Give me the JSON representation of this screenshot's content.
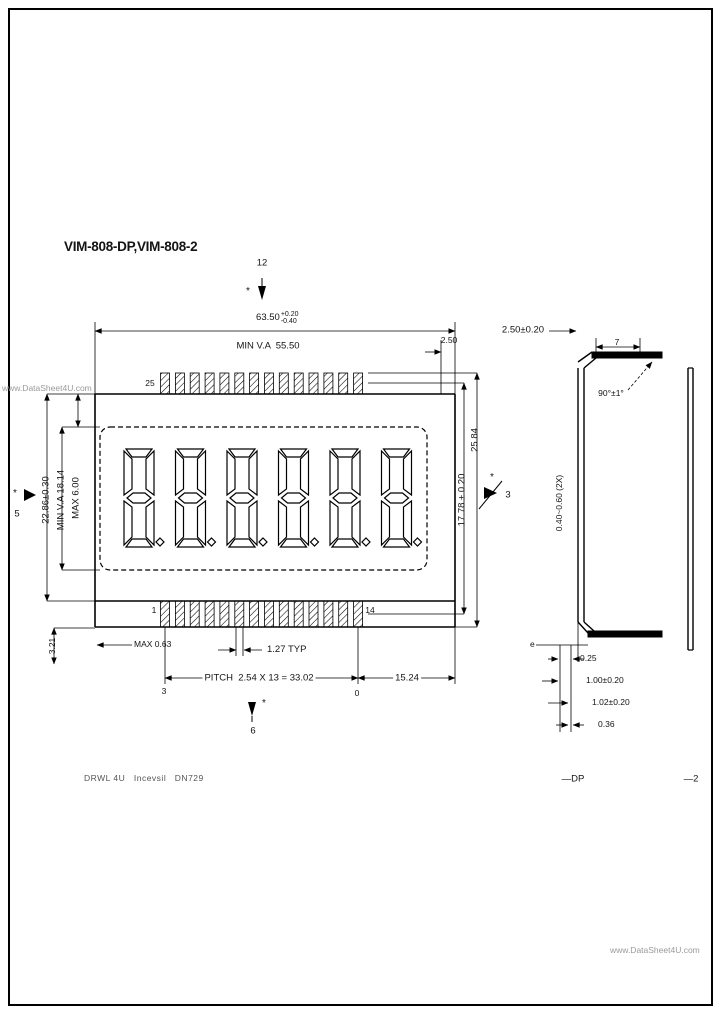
{
  "watermarks": {
    "top_left": "www.DataSheet4U.com",
    "bottom_right": "www.DataSheet4U.com"
  },
  "title": "VIM-808-DP,VIM-808-2",
  "front": {
    "marker_top": {
      "num": "12",
      "star": "*"
    },
    "marker_bottom": {
      "num": "6",
      "star": "*"
    },
    "marker_left": {
      "num": "5",
      "star": "*"
    },
    "marker_right": {
      "num": "3",
      "star": "*"
    },
    "width_dim": {
      "value": "63.50",
      "tol_plus": "+0.20",
      "tol_minus": "-0.40"
    },
    "va_width": "MIN V.A  55.50",
    "corner_offset": "2.50",
    "left": {
      "overall": "22.86±0.30",
      "va": "MIN V.A 18.14",
      "margin": "MAX 6.00"
    },
    "right": {
      "pin_span": "17.78 ± 0.20",
      "overall": "25.84"
    },
    "pins": {
      "top_left": "25",
      "bottom_left": "1",
      "bottom_right": "14"
    },
    "bottom": {
      "max_off": "MAX 0.63",
      "pin_len": "3.21",
      "pin_width": "1.27 TYP",
      "pitch": "PITCH  2.54 X 13 = 33.02",
      "end": "15.24",
      "ref_a": "3",
      "ref_b": "0"
    }
  },
  "side": {
    "glass_thickness": "2.50±0.20",
    "top_dim": "7",
    "bend_angle": "90°±1°",
    "pin_thickness": "0.40~0.60 (2X)",
    "bottom_dims": [
      "0.25",
      "1.00±0.20",
      "1.02±0.20",
      "0.36"
    ],
    "baseline_label": "e",
    "variant_dp": "—DP",
    "variant_2": "—2"
  },
  "footer": "DRWL 4U   Incevsil   DN729"
}
